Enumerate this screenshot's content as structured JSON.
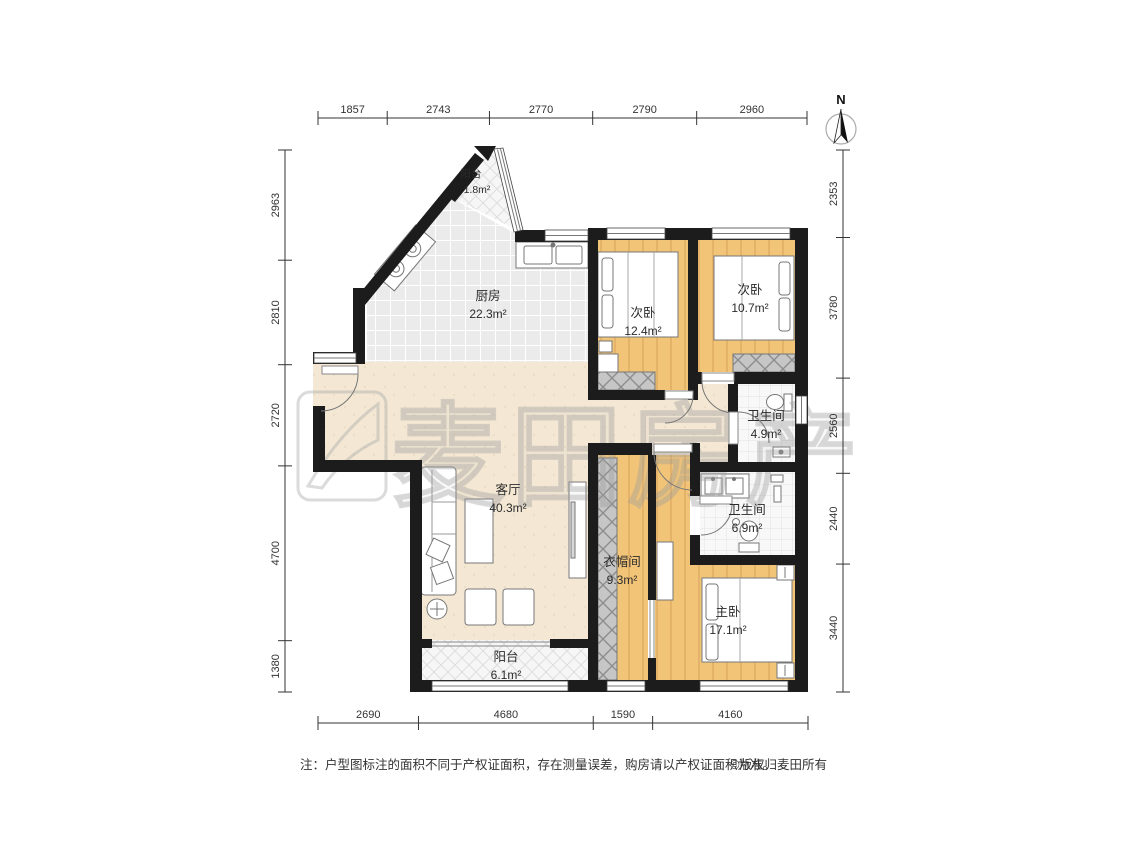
{
  "north": {
    "label": "N"
  },
  "watermark": {
    "text": "麦田房产"
  },
  "rooms": {
    "balcony_top": {
      "name": "阳台",
      "area": "1.8m²"
    },
    "kitchen": {
      "name": "厨房",
      "area": "22.3m²"
    },
    "bedroom_a": {
      "name": "次卧",
      "area": "12.4m²"
    },
    "bedroom_b": {
      "name": "次卧",
      "area": "10.7m²"
    },
    "bathroom_a": {
      "name": "卫生间",
      "area": "4.9m²"
    },
    "bathroom_b": {
      "name": "卫生间",
      "area": "6.9m²"
    },
    "living": {
      "name": "客厅",
      "area": "40.3m²"
    },
    "cloakroom": {
      "name": "衣帽间",
      "area": "9.3m²"
    },
    "master": {
      "name": "主卧",
      "area": "17.1m²"
    },
    "balcony_bottom": {
      "name": "阳台",
      "area": "6.1m²"
    }
  },
  "dimensions": {
    "top": [
      1857,
      2743,
      2770,
      2790,
      2960
    ],
    "bottom": [
      2690,
      4680,
      1590,
      4160
    ],
    "left": [
      2963,
      2810,
      2720,
      4700,
      1380
    ],
    "right": [
      2353,
      3780,
      2560,
      2440,
      3440
    ]
  },
  "note": {
    "text": "注：户型图标注的面积不同于产权证面积，存在测量误差，购房请以产权证面积为准。",
    "copyright": "©版权归麦田所有"
  }
}
